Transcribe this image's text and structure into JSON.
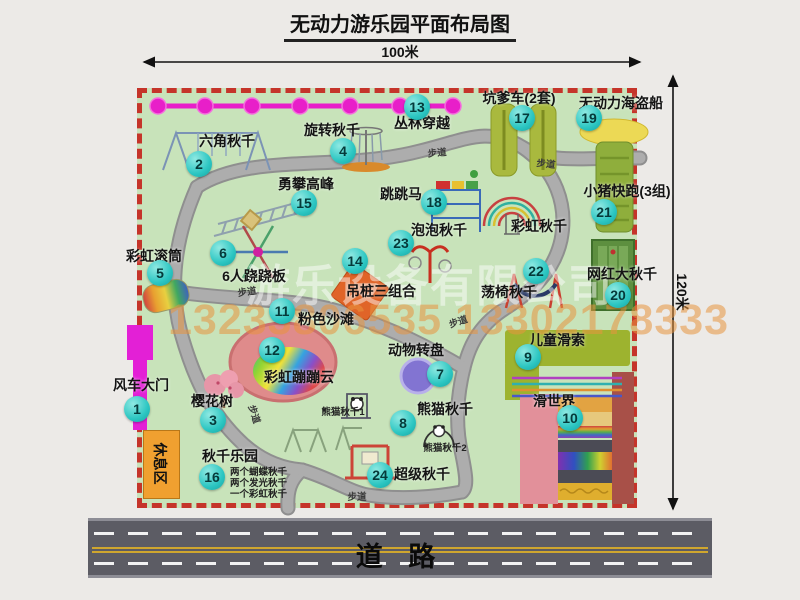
{
  "title": "无动力游乐园平面布局图",
  "dim_top": "100米",
  "dim_right": "120米",
  "road": {
    "label": "道  路"
  },
  "watermark": {
    "company": "游乐设备有限公司",
    "phone": "13233806535 13302178333"
  },
  "rest_area": "休息区",
  "path_label": "步道",
  "path_label_positions": [
    {
      "x": 247,
      "y": 291,
      "rot": -8
    },
    {
      "x": 437,
      "y": 152,
      "rot": -5
    },
    {
      "x": 458,
      "y": 321,
      "rot": -18
    },
    {
      "x": 357,
      "y": 496,
      "rot": 0
    },
    {
      "x": 546,
      "y": 163,
      "rot": 6
    },
    {
      "x": 255,
      "y": 414,
      "rot": 72
    }
  ],
  "attractions": [
    {
      "num": 1,
      "name": "风车大门",
      "cx": 137,
      "cy": 409,
      "lx": 141,
      "ly": 385
    },
    {
      "num": 2,
      "name": "六角秋千",
      "cx": 199,
      "cy": 164,
      "lx": 227,
      "ly": 141
    },
    {
      "num": 3,
      "name": "樱花树",
      "cx": 213,
      "cy": 420,
      "lx": 212,
      "ly": 401
    },
    {
      "num": 4,
      "name": "旋转秋千",
      "cx": 343,
      "cy": 151,
      "lx": 332,
      "ly": 130
    },
    {
      "num": 5,
      "name": "彩虹滚筒",
      "cx": 160,
      "cy": 273,
      "lx": 154,
      "ly": 256
    },
    {
      "num": 6,
      "name": "6人跷跷板",
      "cx": 223,
      "cy": 253,
      "lx": 254,
      "ly": 276
    },
    {
      "num": 7,
      "name": "动物转盘",
      "cx": 440,
      "cy": 374,
      "lx": 416,
      "ly": 350
    },
    {
      "num": 8,
      "name": "熊猫秋千",
      "cx": 403,
      "cy": 423,
      "lx": 445,
      "ly": 409
    },
    {
      "num": 9,
      "name": "儿童滑索",
      "cx": 528,
      "cy": 357,
      "lx": 557,
      "ly": 340
    },
    {
      "num": 10,
      "name": "滑世界",
      "cx": 570,
      "cy": 418,
      "lx": 554,
      "ly": 401
    },
    {
      "num": 11,
      "name": "粉色沙滩",
      "cx": 282,
      "cy": 311,
      "lx": 326,
      "ly": 319
    },
    {
      "num": 12,
      "name": "彩虹蹦蹦云",
      "cx": 272,
      "cy": 350,
      "lx": 299,
      "ly": 377
    },
    {
      "num": 13,
      "name": "丛林穿越",
      "cx": 417,
      "cy": 107,
      "lx": 422,
      "ly": 123
    },
    {
      "num": 14,
      "name": "吊桩三组合",
      "cx": 355,
      "cy": 261,
      "lx": 381,
      "ly": 291
    },
    {
      "num": 15,
      "name": "勇攀高峰",
      "cx": 304,
      "cy": 203,
      "lx": 306,
      "ly": 184
    },
    {
      "num": 16,
      "name": "秋千乐园",
      "cx": 212,
      "cy": 477,
      "lx": 230,
      "ly": 456
    },
    {
      "num": 17,
      "name": "坑爹车(2套)",
      "cx": 522,
      "cy": 118,
      "lx": 519,
      "ly": 98
    },
    {
      "num": 18,
      "name": "跳跳马",
      "cx": 434,
      "cy": 202,
      "lx": 401,
      "ly": 194
    },
    {
      "num": 19,
      "name": "无动力海盗船",
      "cx": 589,
      "cy": 118,
      "lx": 621,
      "ly": 103
    },
    {
      "num": 20,
      "name": "网红大秋千",
      "cx": 618,
      "cy": 295,
      "lx": 622,
      "ly": 274
    },
    {
      "num": 21,
      "name": "小猪快跑(3组)",
      "cx": 604,
      "cy": 212,
      "lx": 627,
      "ly": 191
    },
    {
      "num": 22,
      "name": "荡椅秋千",
      "cx": 536,
      "cy": 271,
      "lx": 509,
      "ly": 292
    },
    {
      "num": 23,
      "name": "泡泡秋千",
      "cx": 401,
      "cy": 243,
      "lx": 439,
      "ly": 230
    },
    {
      "num": 24,
      "name": "超级秋千",
      "cx": 380,
      "cy": 475,
      "lx": 422,
      "ly": 474
    }
  ],
  "extra_labels": [
    {
      "text": "彩虹秋千",
      "x": 539,
      "y": 226,
      "cls": "albl"
    },
    {
      "text": "熊猫秋千1",
      "x": 343,
      "y": 411,
      "cls": "slbl"
    },
    {
      "text": "熊猫秋千2",
      "x": 445,
      "y": 447,
      "cls": "slbl"
    },
    {
      "text": "两个蝴蝶秋千",
      "x": 230,
      "y": 471,
      "cls": "slbl left"
    },
    {
      "text": "两个发光秋千",
      "x": 230,
      "y": 482,
      "cls": "slbl left"
    },
    {
      "text": "一个彩虹秋千",
      "x": 230,
      "y": 493,
      "cls": "slbl left"
    }
  ],
  "colors": {
    "map_green": "#c8e3ba",
    "border_red": "#c5342a",
    "path_gray": "#a8a8a8",
    "marker_teal": "#2cc6c2",
    "road_gray": "#5c5c64",
    "zipline_magenta": "#e81fc9",
    "gate_magenta": "#e320d6",
    "rest_orange": "#f0a030",
    "pirate_yellow": "#ecd955",
    "beach_pink": "#df8b8b",
    "watermark_orange": "rgba(231,148,62,0.55)"
  }
}
